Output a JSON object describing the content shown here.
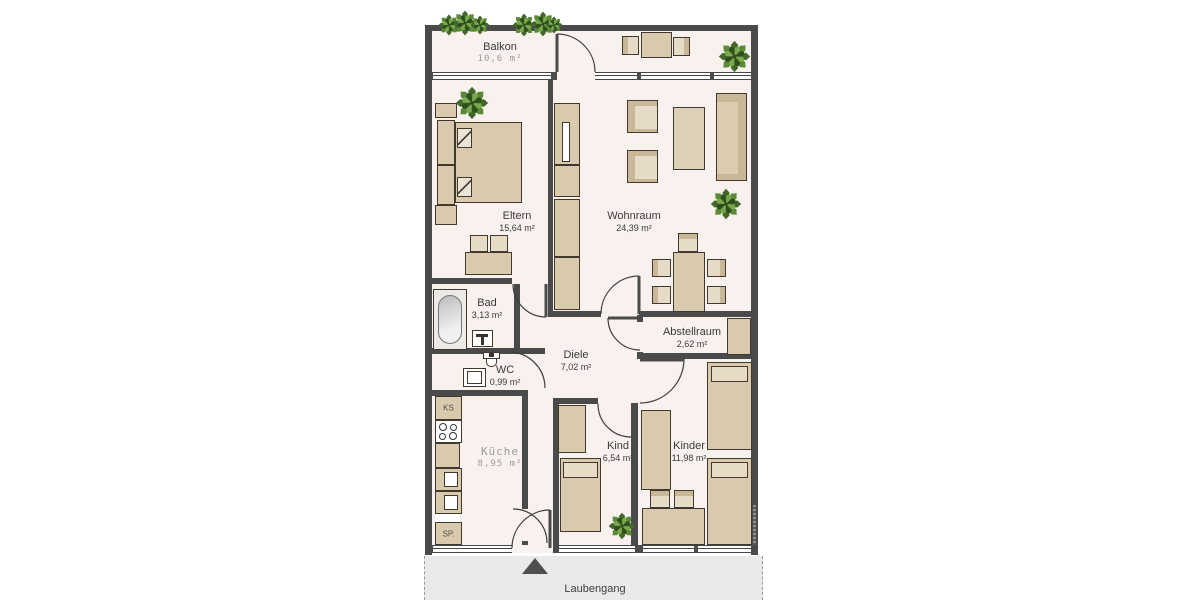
{
  "plan": {
    "title": "Grundriss Wohnung",
    "rooms": [
      {
        "id": "balkon",
        "name": "Balkon",
        "area": "10,6 m²"
      },
      {
        "id": "eltern",
        "name": "Eltern",
        "area": "15,64 m²"
      },
      {
        "id": "wohnraum",
        "name": "Wohnraum",
        "area": "24,39 m²"
      },
      {
        "id": "bad",
        "name": "Bad",
        "area": "3,13 m²"
      },
      {
        "id": "wc",
        "name": "WC",
        "area": "0,99 m²"
      },
      {
        "id": "diele",
        "name": "Diele",
        "area": "7,02 m²"
      },
      {
        "id": "abstellraum",
        "name": "Abstellraum",
        "area": "2,62 m²"
      },
      {
        "id": "kueche",
        "name": "Küche",
        "area": "8,95 m²"
      },
      {
        "id": "kind",
        "name": "Kind",
        "area": "6,54 m²"
      },
      {
        "id": "kinder",
        "name": "Kinder",
        "area": "11,98 m²"
      }
    ],
    "outdoor": {
      "label": "Laubengang"
    },
    "kitchen_units": {
      "fridge": "KS",
      "sink_unit": "SP."
    },
    "colors": {
      "wall": "#4a4a4a",
      "floor": "#f8f1ee",
      "furniture": "#d9caae",
      "furniture_light": "#e6dbc6",
      "outdoor_strip": "#e9e9e9",
      "plant_green": "#4d7b2d",
      "label_text": "#3a3a3a",
      "muted_text": "#9b9b9b"
    }
  }
}
